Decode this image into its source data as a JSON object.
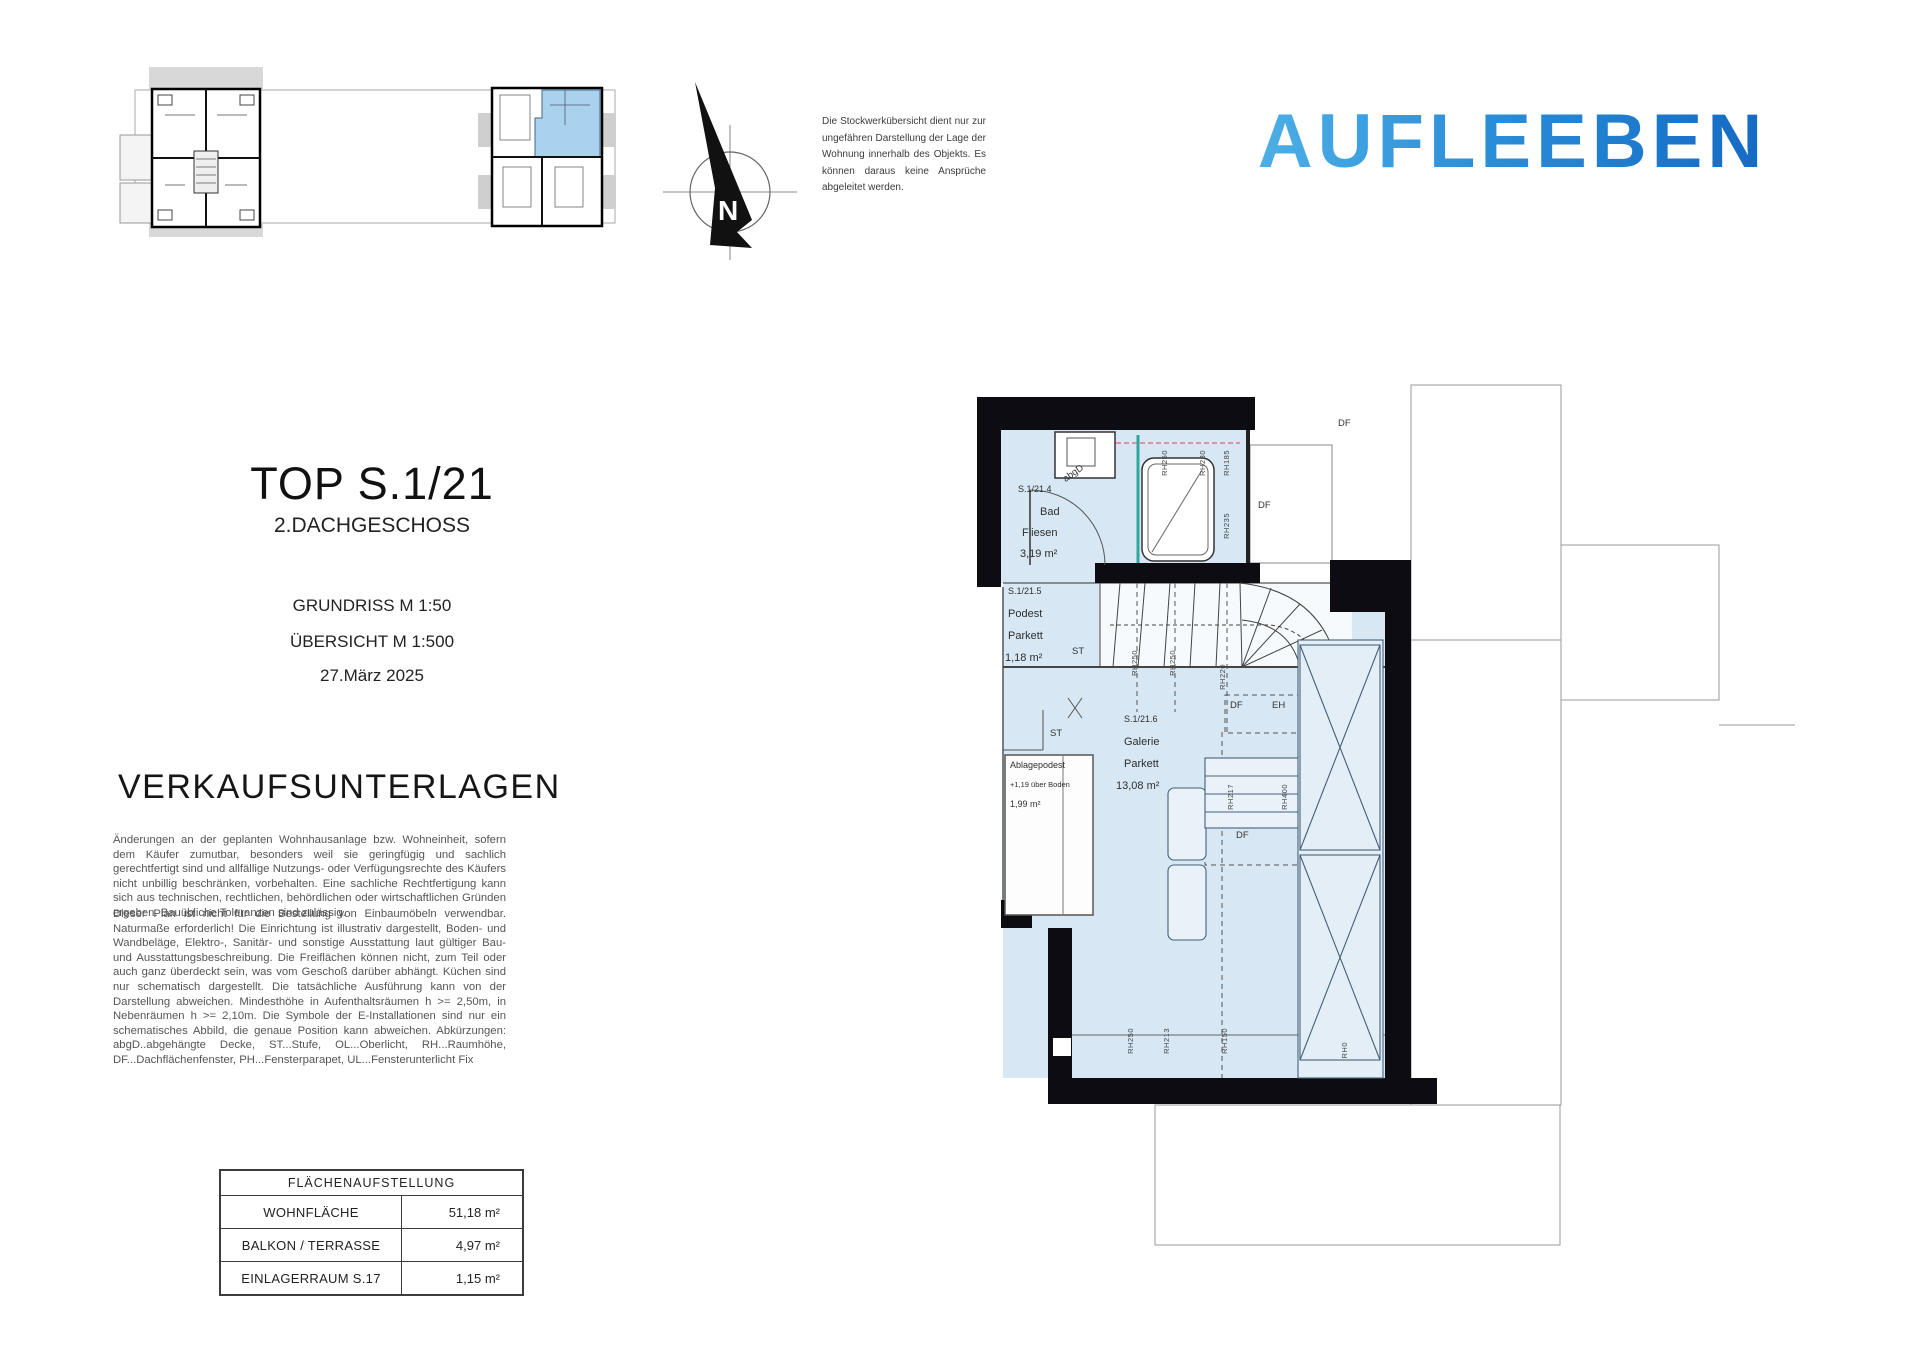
{
  "header": {
    "disclaimer": "Die Stockwerkübersicht dient nur zur ungefähren Darstellung der Lage der Wohnung innerhalb des Objekts. Es können daraus keine Ansprüche abgeleitet werden.",
    "logo_text": "AUFLEEBEN",
    "logo_gradient_from": "#56b7ea",
    "logo_gradient_to": "#0f62c0"
  },
  "title_block": {
    "unit": "TOP S.1/21",
    "floor": "2.DACHGESCHOSS",
    "scale_plan": "GRUNDRISS M 1:50",
    "scale_overview": "ÜBERSICHT M 1:500",
    "date": "27.März 2025"
  },
  "sales_heading": "VERKAUFSUNTERLAGEN",
  "legal": {
    "p1": "Änderungen an der geplanten Wohnhausanlage bzw. Wohneinheit, sofern dem Käufer zumutbar, besonders weil sie geringfügig und sachlich gerechtfertigt sind und allfällige Nutzungs- oder Verfügungsrechte des Käufers nicht unbillig beschränken, vorbehalten. Eine sachliche Rechtfertigung kann sich aus technischen, rechtlichen, behördlichen oder wirtschaftlichen Gründen ergeben. Bauübliche Toleranzen sind zulässig.",
    "p2": "Dieser Plan ist nicht für die Bestellung von Einbaumöbeln verwendbar. Naturmaße erforderlich! Die Einrichtung ist illustrativ dargestellt, Boden- und Wandbeläge, Elektro-, Sanitär- und sonstige Ausstattung laut gültiger Bau- und Ausstattungsbeschreibung. Die Freiflächen können nicht, zum Teil oder auch ganz überdeckt sein, was vom Geschoß darüber abhängt. Küchen sind nur schematisch dargestellt. Die tatsächliche Ausführung kann von der Darstellung abweichen. Mindesthöhe in Aufenthaltsräumen h >= 2,50m, in Nebenräumen h >= 2,10m. Die Symbole der E-Installationen sind nur ein schematisches Abbild, die genaue Position kann abweichen. Abkürzungen: abgD..abgehängte Decke, ST...Stufe, OL...Oberlicht, RH...Raumhöhe, DF...Dachflächenfenster, PH...Fensterparapet, UL...Fensterunterlicht Fix"
  },
  "area_table": {
    "title": "FLÄCHENAUFSTELLUNG",
    "rows": [
      {
        "label": "WOHNFLÄCHE",
        "value": "51,18 m²"
      },
      {
        "label": "BALKON / TERRASSE",
        "value": "4,97 m²"
      },
      {
        "label": "EINLAGERRAUM S.17",
        "value": "1,15 m²"
      }
    ]
  },
  "plan": {
    "rooms": {
      "bad": {
        "id": "S.1/21.4",
        "name": "Bad",
        "floor": "Fliesen",
        "area": "3,19 m²"
      },
      "podest": {
        "id": "S.1/21.5",
        "name": "Podest",
        "floor": "Parkett",
        "area": "1,18 m²"
      },
      "galerie": {
        "id": "S.1/21.6",
        "name": "Galerie",
        "floor": "Parkett",
        "area": "13,08 m²"
      }
    },
    "ablagepodest": {
      "name": "Ablagepodest",
      "height_note": "+1,19 über Boden",
      "area": "1,99 m²"
    },
    "annotations": {
      "st": "ST",
      "df": "DF",
      "eh": "EH",
      "abgd": "abgD",
      "north": "N"
    },
    "room_heights": {
      "bath": [
        "RH250",
        "RH230",
        "RH185",
        "RH235"
      ],
      "stair": [
        "RH250",
        "RH250",
        "RH220"
      ],
      "galerie": [
        "RH217",
        "RH400"
      ],
      "bottom": [
        "RH250",
        "RH213",
        "RH150",
        "RH0"
      ]
    },
    "colors": {
      "floor": "#d7e8f4",
      "wall": "#0c0c12",
      "glass": "#2fa79b",
      "overview_unit": "#a8d2ee"
    }
  }
}
